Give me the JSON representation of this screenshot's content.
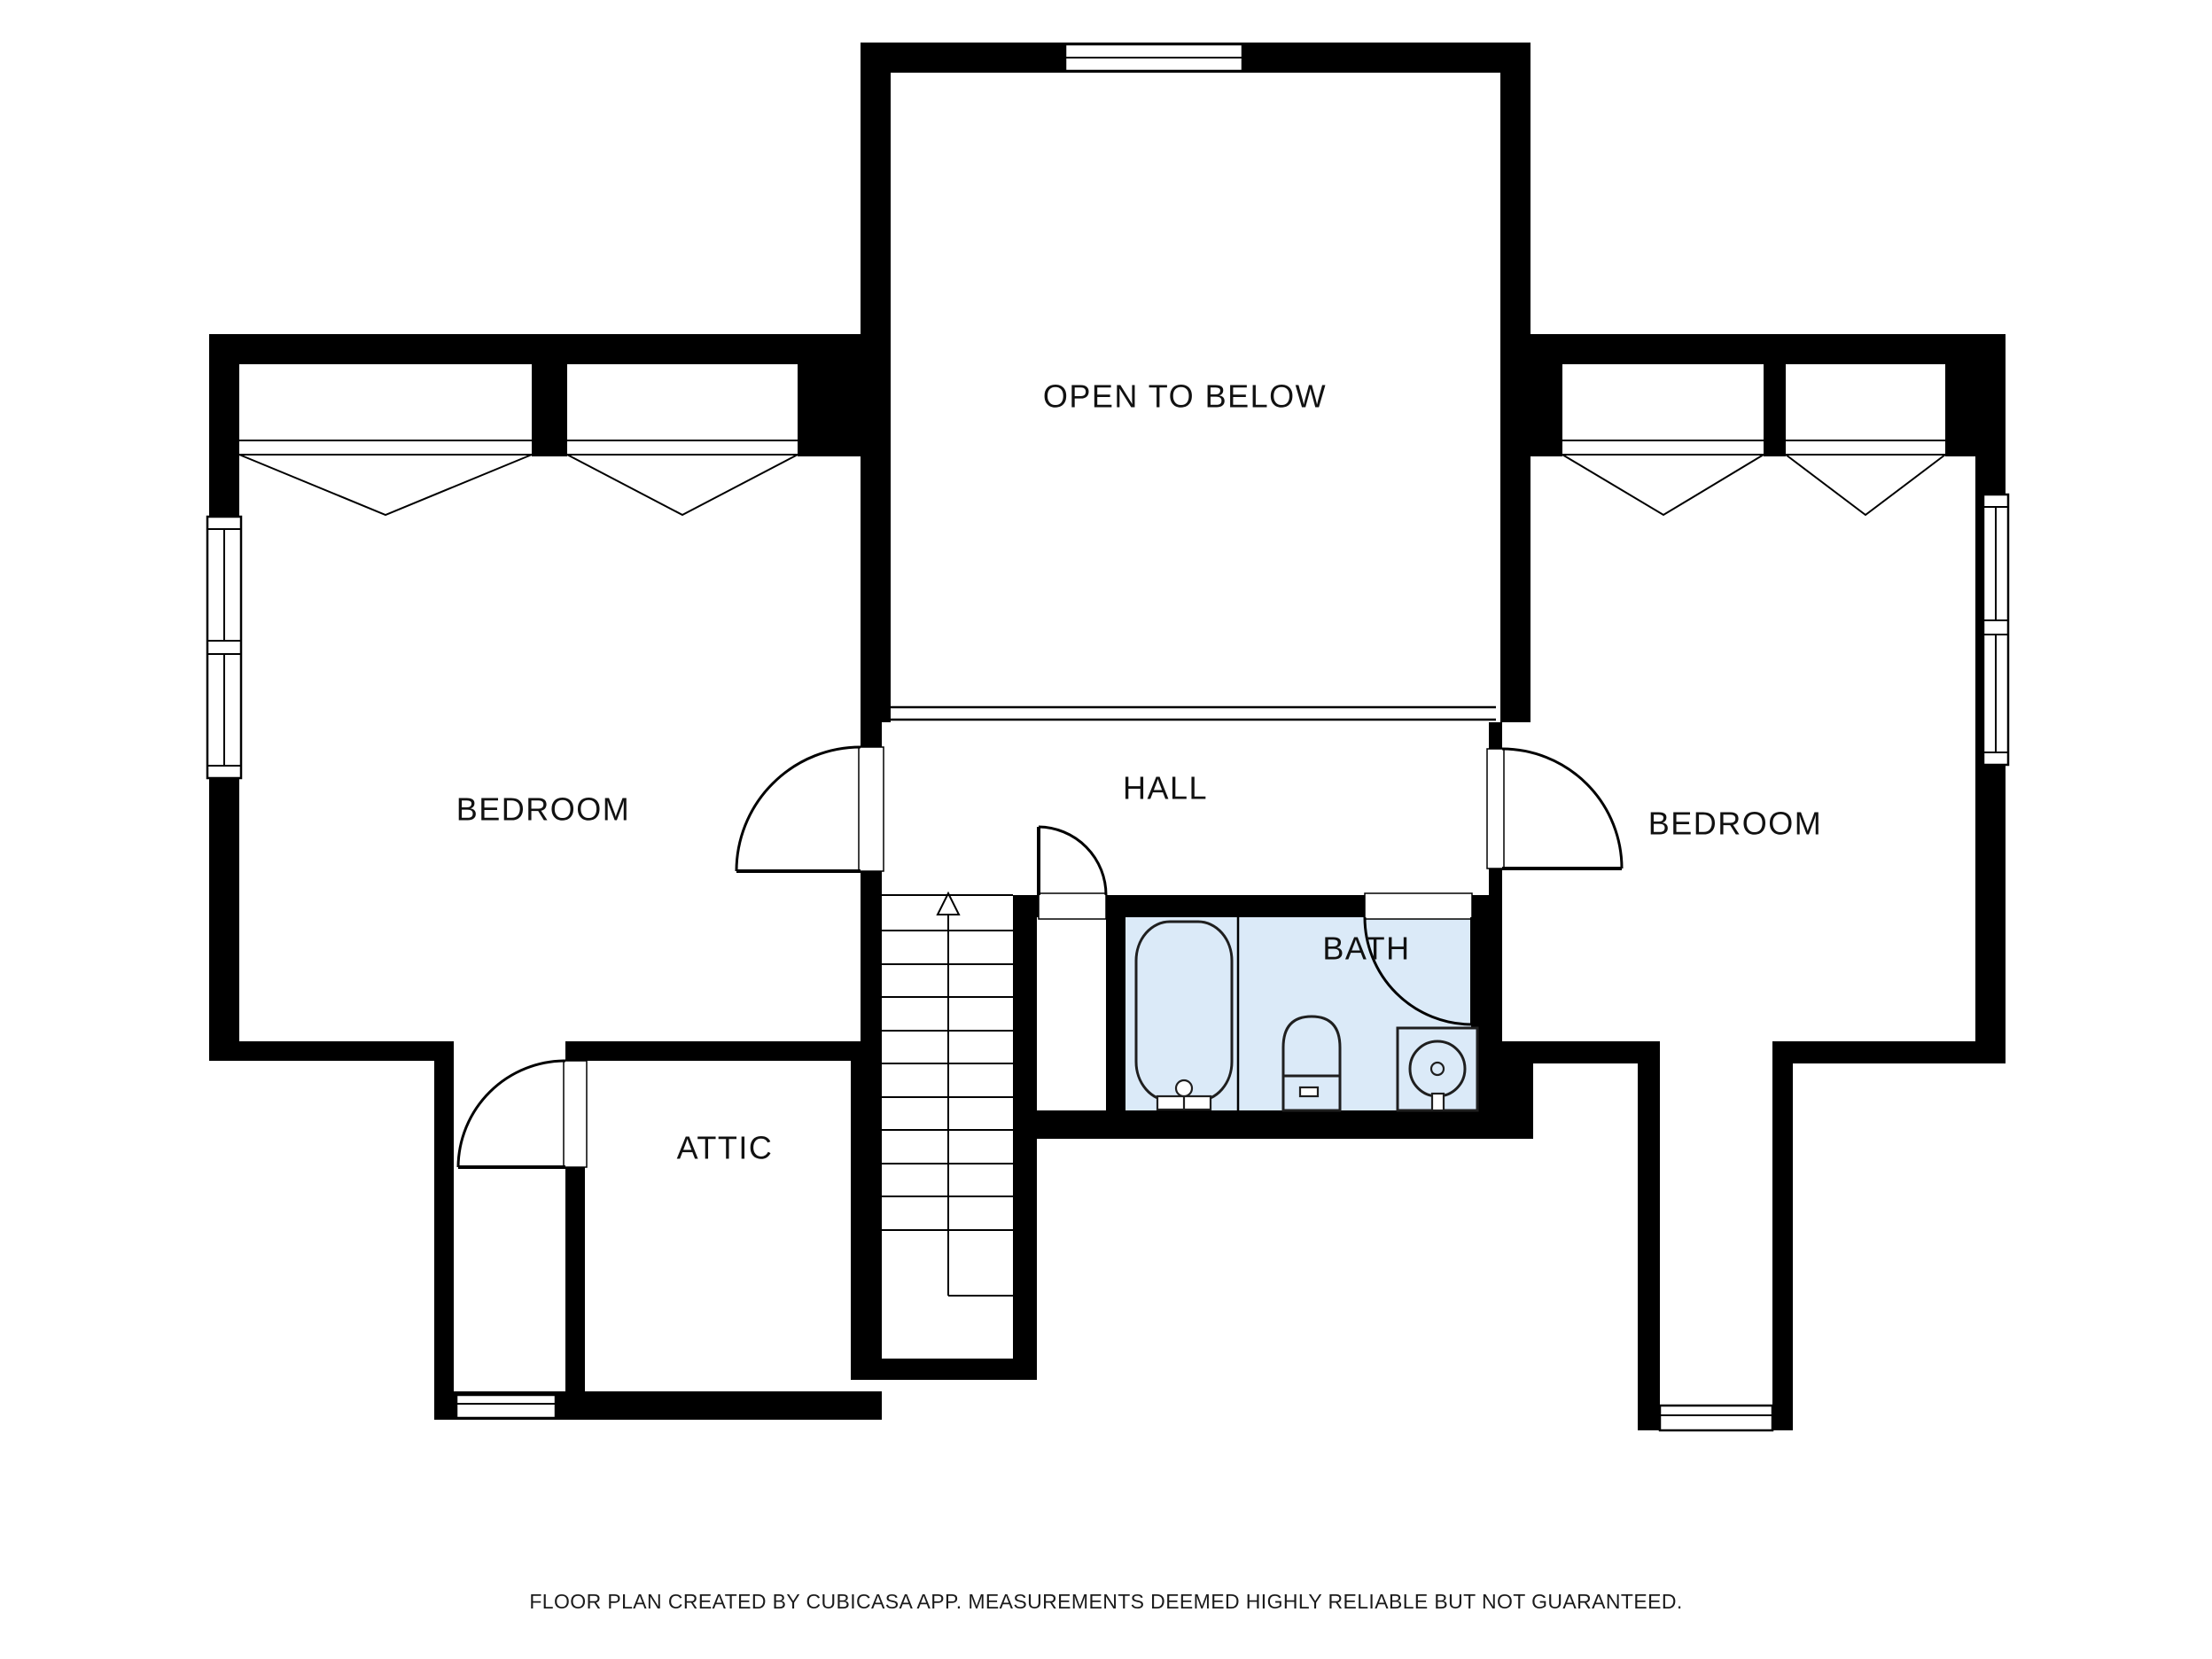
{
  "page": {
    "background": "#ffffff"
  },
  "colors": {
    "wall": "#000000",
    "line": "#000000",
    "bath_floor": "#dbeaf8",
    "label_text": "#111111",
    "footer_text": "#1a1a1a"
  },
  "rooms": {
    "open_to_below": "OPEN TO BELOW",
    "bedroom_left": "BEDROOM",
    "hall": "HALL",
    "bedroom_right": "BEDROOM",
    "bath": "BATH",
    "attic": "ATTIC"
  },
  "stairs": {
    "direction": "up"
  },
  "footer": {
    "disclaimer": "FLOOR PLAN CREATED BY CUBICASA APP. MEASUREMENTS DEEMED HIGHLY RELIABLE BUT NOT GUARANTEED."
  }
}
